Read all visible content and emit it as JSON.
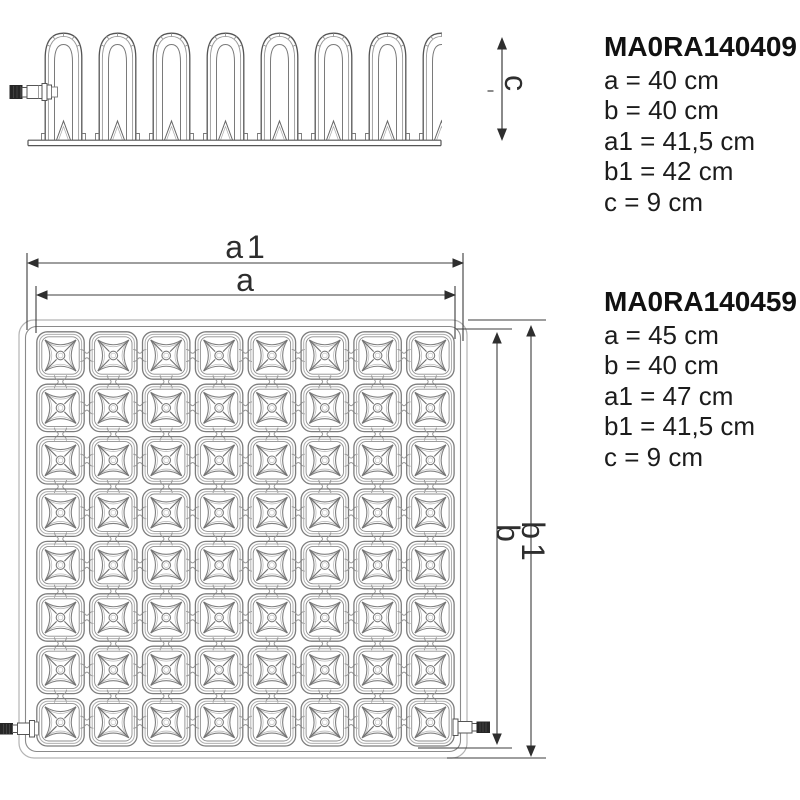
{
  "colors": {
    "background": "#ffffff",
    "line_dark": "#4a4a4a",
    "line_light": "#b3b3b3",
    "dimension": "#3d3d3d",
    "arrow_fill": "#2e2e2e",
    "text": "#1c1c1c"
  },
  "dimension_labels": {
    "a1": "a1",
    "a": "a",
    "b": "b",
    "b1": "b1",
    "c": "c"
  },
  "products": [
    {
      "code": "MA0RA140409",
      "specs": [
        "a = 40 cm",
        "b = 40 cm",
        "a1 = 41,5 cm",
        "b1 = 42 cm",
        "c = 9 cm"
      ]
    },
    {
      "code": "MA0RA140459",
      "specs": [
        "a = 45 cm",
        "b = 40 cm",
        "a1 = 47 cm",
        "b1 = 41,5 cm",
        "c = 9 cm"
      ]
    }
  ],
  "drawing": {
    "top_view_grid": {
      "rows": 8,
      "cols": 8
    },
    "side_view": {
      "dome_count": 8
    }
  }
}
